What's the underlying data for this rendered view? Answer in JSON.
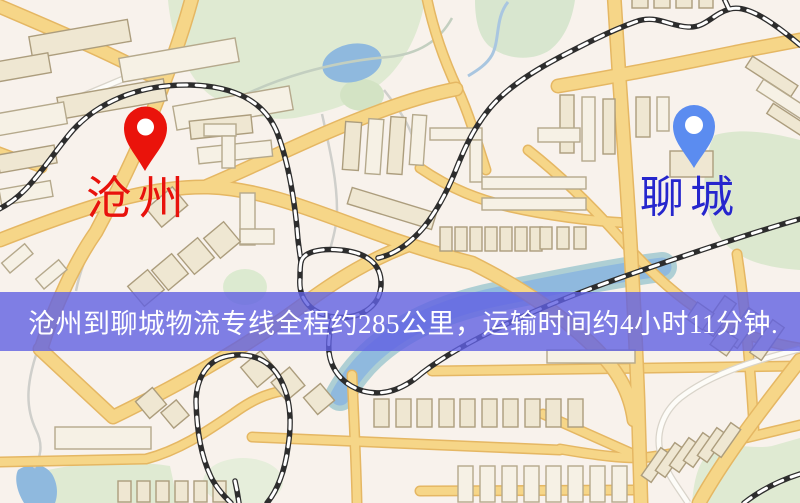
{
  "title": "沧州到聊城物流专线地图",
  "markers": [
    {
      "id": "cangzhou",
      "label": "沧州",
      "pin_color": "#ea130b",
      "label_color": "#e8120c"
    },
    {
      "id": "liaocheng",
      "label": "聊城",
      "pin_color": "#5b8cf0",
      "label_color": "#2626cd"
    }
  ],
  "banner": {
    "text": "沧州到聊城物流专线全程约285公里，运输时间约4小时11分钟.",
    "background_color": "#6060e2",
    "text_color": "#ffffff"
  },
  "route": {
    "origin": "沧州",
    "destination": "聊城",
    "distance_km": 285,
    "duration": "4小时11分钟"
  }
}
